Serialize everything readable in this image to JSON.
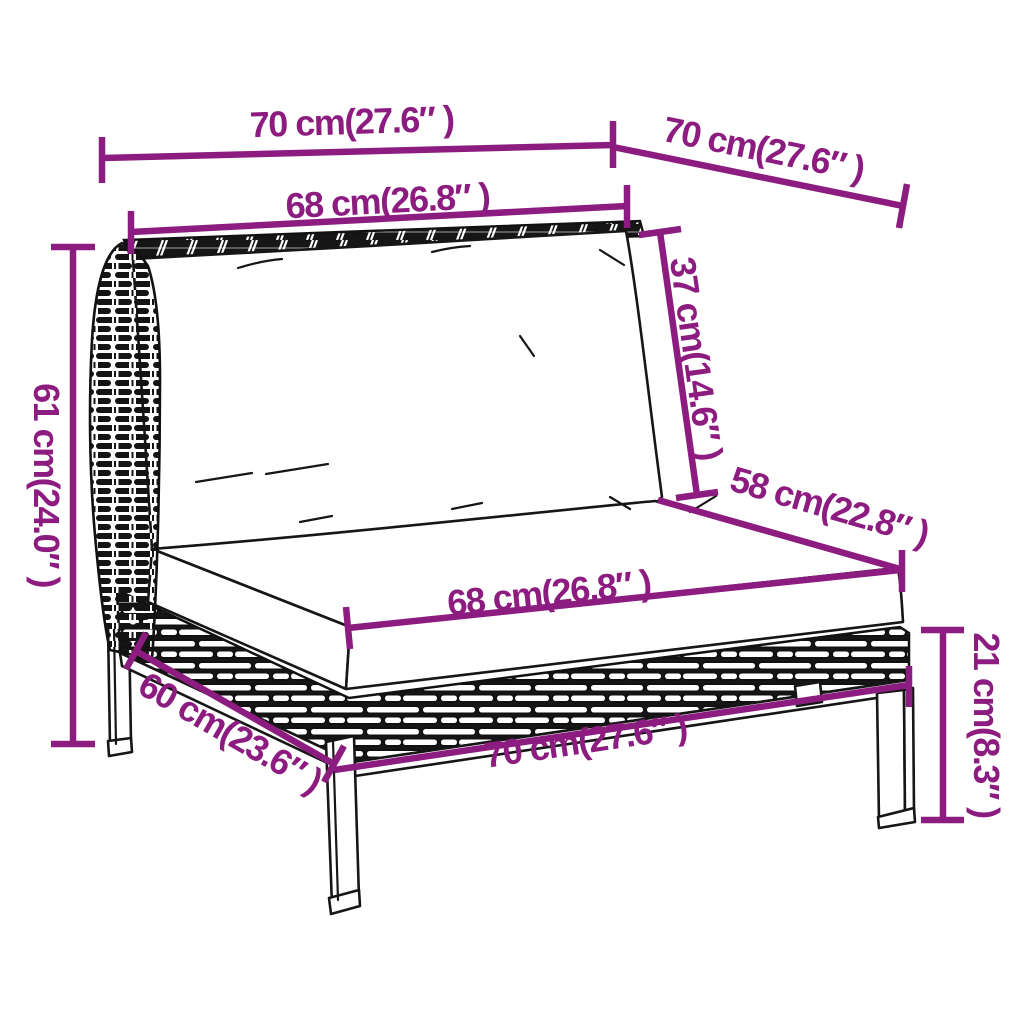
{
  "diagram": {
    "background": "#ffffff",
    "accent_color": "#8d1c80",
    "ink_color": "#161616",
    "subject": "rattan sofa section with cushions - dimension drawing",
    "labels": {
      "top_width": "70 cm(27.6″ )",
      "side_depth": "70 cm(27.6″ )",
      "back_cushion_width": "68 cm(26.8″ )",
      "back_cushion_height": "37 cm(14.6″ )",
      "overall_height": "61 cm(24.0″ )",
      "seat_depth": "58 cm(22.8″ )",
      "seat_cushion_width": "68 cm(26.8″ )",
      "base_depth": "60 cm(23.6″ )",
      "base_width": "70 cm(27.6″ )",
      "leg_height": "21 cm(8.3″ )"
    }
  }
}
